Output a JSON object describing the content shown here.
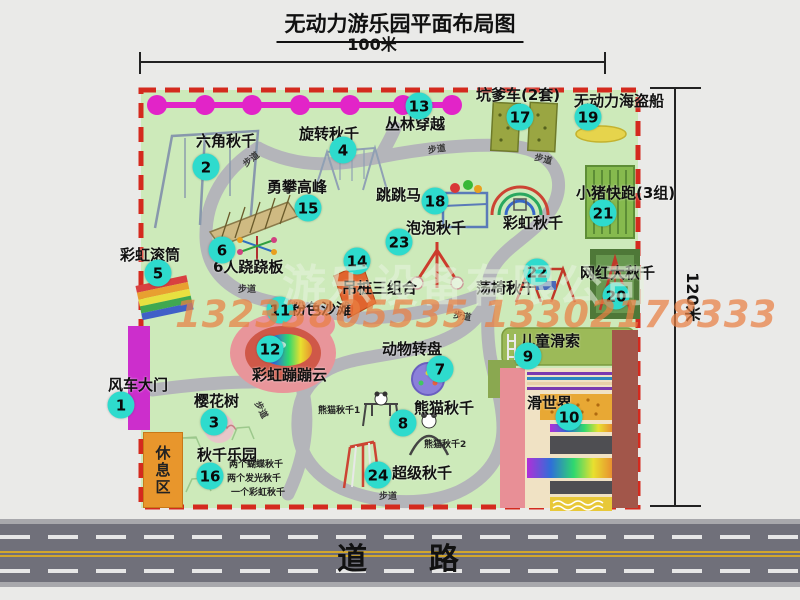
{
  "title": "无动力游乐园平面布局图",
  "dimensions": {
    "width_label": "100米",
    "height_label": "120米"
  },
  "road": {
    "label": "道    路"
  },
  "watermark": {
    "company": "游乐设备有限公司",
    "phones": "13233805535 13302178333"
  },
  "rest_area": {
    "label": "休息区"
  },
  "colors": {
    "park_green": "#cdeaba",
    "border_red": "#d42a1e",
    "marker_cyan": "#2edbcd",
    "chain_magenta": "#e224c8",
    "road_gray": "#70707a",
    "gate_magenta": "#cc2ecc",
    "rest_area_orange": "#e8962c"
  },
  "path_labels": [
    {
      "t": "步道",
      "x": 243,
      "y": 156,
      "r": -38
    },
    {
      "t": "步道",
      "x": 428,
      "y": 146,
      "r": -8
    },
    {
      "t": "步道",
      "x": 534,
      "y": 156,
      "r": 14
    },
    {
      "t": "步道",
      "x": 238,
      "y": 286,
      "r": 0
    },
    {
      "t": "步道",
      "x": 453,
      "y": 313,
      "r": 10
    },
    {
      "t": "步道",
      "x": 251,
      "y": 406,
      "r": 62
    },
    {
      "t": "步道",
      "x": 379,
      "y": 493,
      "r": 0
    }
  ],
  "attractions": [
    {
      "num": 1,
      "label": "风车大门",
      "lx": 108,
      "ly": 378,
      "mx": 121,
      "my": 405
    },
    {
      "num": 2,
      "label": "六角秋千",
      "lx": 196,
      "ly": 134,
      "mx": 206,
      "my": 167
    },
    {
      "num": 3,
      "label": "樱花树",
      "lx": 194,
      "ly": 394,
      "mx": 214,
      "my": 422
    },
    {
      "num": 4,
      "label": "旋转秋千",
      "lx": 299,
      "ly": 127,
      "mx": 343,
      "my": 150
    },
    {
      "num": 5,
      "label": "彩虹滚筒",
      "lx": 120,
      "ly": 248,
      "mx": 158,
      "my": 273
    },
    {
      "num": 6,
      "label": "6人跷跷板",
      "lx": 213,
      "ly": 260,
      "mx": 222,
      "my": 250
    },
    {
      "num": 7,
      "label": "动物转盘",
      "lx": 382,
      "ly": 342,
      "mx": 440,
      "my": 369
    },
    {
      "num": 8,
      "label": "熊猫秋千",
      "lx": 414,
      "ly": 401,
      "mx": 403,
      "my": 423,
      "subs": [
        {
          "t": "熊猫秋千1",
          "x": 318,
          "y": 407
        },
        {
          "t": "熊猫秋千2",
          "x": 424,
          "y": 441
        }
      ]
    },
    {
      "num": 9,
      "label": "儿童滑索",
      "lx": 520,
      "ly": 334,
      "mx": 528,
      "my": 356
    },
    {
      "num": 10,
      "label": "滑世界",
      "lx": 527,
      "ly": 396,
      "mx": 569,
      "my": 417
    },
    {
      "num": 11,
      "label": "粉色沙滩",
      "lx": 291,
      "ly": 302,
      "mx": 280,
      "my": 310
    },
    {
      "num": 12,
      "label": "彩虹蹦蹦云",
      "lx": 252,
      "ly": 368,
      "mx": 270,
      "my": 349
    },
    {
      "num": 13,
      "label": "丛林穿越",
      "lx": 385,
      "ly": 117,
      "mx": 419,
      "my": 106
    },
    {
      "num": 14,
      "label": "吊桩三组合",
      "lx": 342,
      "ly": 281,
      "mx": 357,
      "my": 261
    },
    {
      "num": 15,
      "label": "勇攀高峰",
      "lx": 267,
      "ly": 180,
      "mx": 308,
      "my": 208
    },
    {
      "num": 16,
      "label": "秋千乐园",
      "lx": 197,
      "ly": 448,
      "mx": 210,
      "my": 476,
      "subs": [
        {
          "t": "两个蝴蝶秋千",
          "x": 229,
          "y": 461
        },
        {
          "t": "两个发光秋千",
          "x": 227,
          "y": 475
        },
        {
          "t": "一个彩虹秋千",
          "x": 231,
          "y": 489
        }
      ]
    },
    {
      "num": 17,
      "label": "坑爹车(2套)",
      "lx": 476,
      "ly": 88,
      "mx": 520,
      "my": 117
    },
    {
      "num": 18,
      "label": "跳跳马",
      "lx": 376,
      "ly": 188,
      "mx": 435,
      "my": 201
    },
    {
      "num": 19,
      "label": "无动力海盗船",
      "lx": 574,
      "ly": 94,
      "mx": 588,
      "my": 117
    },
    {
      "num": 20,
      "label": "网红大秋千",
      "lx": 580,
      "ly": 266,
      "mx": 616,
      "my": 296
    },
    {
      "num": 21,
      "label": "小猪快跑(3组)",
      "lx": 576,
      "ly": 186,
      "mx": 603,
      "my": 213
    },
    {
      "num": 22,
      "label": "荡椅秋千",
      "lx": 476,
      "ly": 281,
      "mx": 537,
      "my": 272
    },
    {
      "num": 23,
      "label": "泡泡秋千",
      "lx": 406,
      "ly": 221,
      "mx": 399,
      "my": 242
    },
    {
      "num": 24,
      "label": "超级秋千",
      "lx": 392,
      "ly": 466,
      "mx": 378,
      "my": 475
    },
    {
      "id": "rainbow-swing",
      "label": "彩虹秋千",
      "lx": 503,
      "ly": 216
    }
  ]
}
